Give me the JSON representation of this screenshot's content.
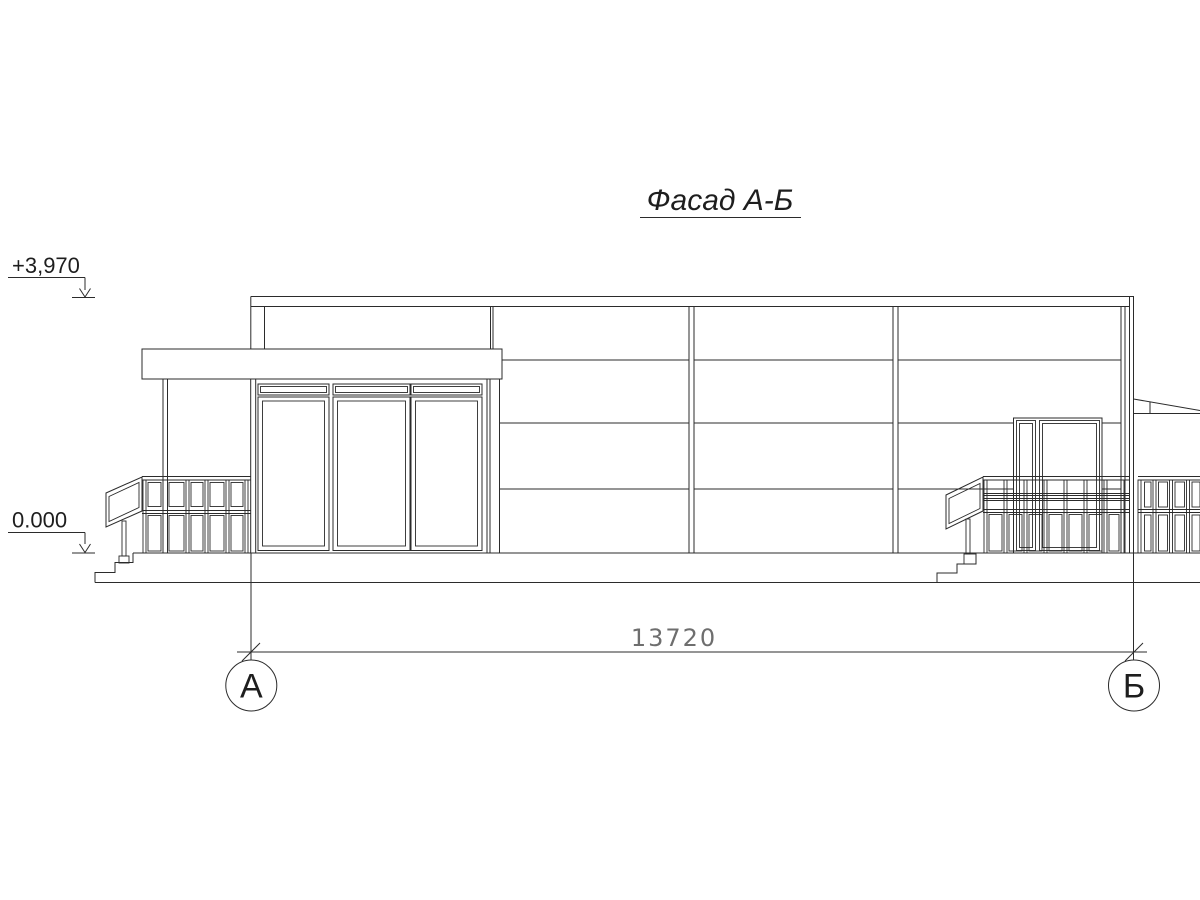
{
  "drawing": {
    "title": "Фасад А-Б",
    "elevation_marks": [
      {
        "label": "+3,970"
      },
      {
        "label": "0.000"
      }
    ],
    "dimension_label": "13720",
    "axes": [
      {
        "label": "А"
      },
      {
        "label": "Б"
      }
    ],
    "colors": {
      "ink": "#2b2b2b",
      "dimension_text": "#6e6e6e",
      "background": "#ffffff"
    }
  }
}
